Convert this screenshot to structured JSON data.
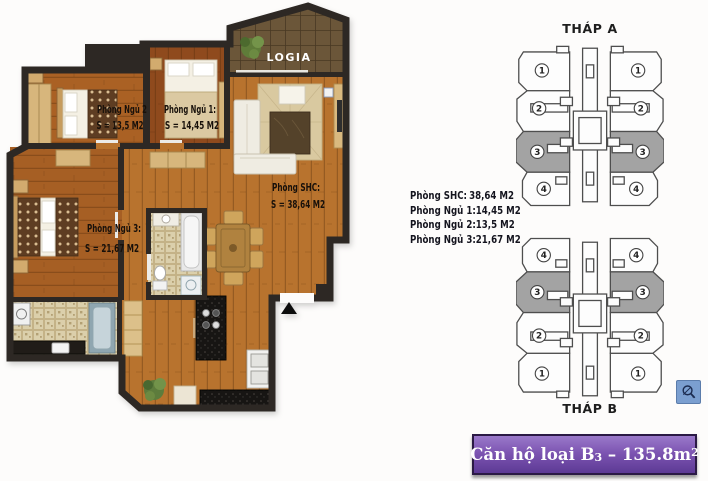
{
  "floor_plan": {
    "logia_label": "LOGIA",
    "bedroom2": {
      "name": "Phòng Ngủ 2",
      "area": "S = 13,5 M2"
    },
    "bedroom1": {
      "name": "Phòng Ngủ 1:",
      "area": "S = 14,45 M2"
    },
    "living": {
      "name": "Phòng SHC:",
      "area": "S = 38,64 M2"
    },
    "bedroom3": {
      "name": "Phòng Ngủ 3:",
      "area": "S = 21,67 M2"
    }
  },
  "area_summary": {
    "rows": [
      {
        "label": "Phòng SHC:",
        "value": "38,64 M2"
      },
      {
        "label": "Phòng Ngủ 1:",
        "value": "14,45 M2"
      },
      {
        "label": "Phòng Ngủ 2:",
        "value": "13,5 M2"
      },
      {
        "label": "Phòng Ngủ 3:",
        "value": "21,67 M2"
      }
    ]
  },
  "towers": {
    "tower_a": {
      "label": "THÁP A",
      "units": [
        "1",
        "2",
        "3",
        "4"
      ]
    },
    "tower_b": {
      "label": "THÁP B",
      "units": [
        "4",
        "3",
        "2",
        "1"
      ]
    },
    "highlighted_unit": "3",
    "highlight_color": "#a3a3a3"
  },
  "banner": {
    "prefix": "Căn hộ loại B",
    "subscript": "3",
    "middle": " – 135.8m",
    "superscript": "2",
    "background": "#6f49a8",
    "border": "#2b1a45"
  },
  "colors": {
    "wall": "#2d2824",
    "wood_hall": "#b8732e",
    "wood_bedroom1": "#8f4a1d",
    "tile_bath": "#dbcfab",
    "logia_tile": "#6b5639"
  }
}
